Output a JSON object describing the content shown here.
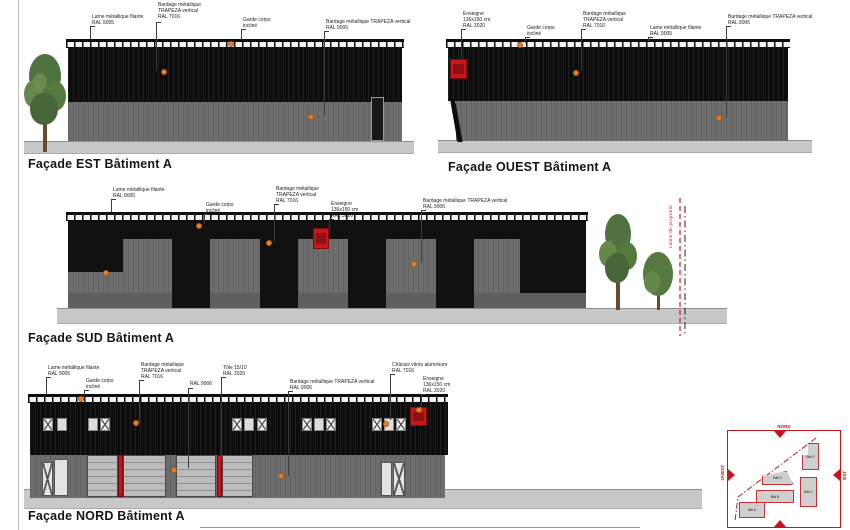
{
  "sheet": {
    "type_label": "Plan de façades",
    "colors": {
      "accent_red_ral3020": "#c3171b",
      "marker_orange": "#ee7e20",
      "cladding_dark_ral7016": "#0d0d0d",
      "cladding_gray_ral9006": "#6d6d6d",
      "ground_gray": "#c8c8c8"
    }
  },
  "facade_est": {
    "title": "Façade EST Bâtiment A",
    "annotations": [
      {
        "text": "Lame métallique filante\nRAL 9005"
      },
      {
        "text": "Bardage métallique\nTRAPEZA vertical\nRAL 7016"
      },
      {
        "text": "Garde corps\nincliné"
      },
      {
        "text": "Bardage métallique TRAPEZA vertical\nRAL 9006"
      }
    ]
  },
  "facade_ouest": {
    "title": "Façade OUEST Bâtiment A",
    "annotations": [
      {
        "text": "Enseigne\n136x150 cm\nRAL 3020"
      },
      {
        "text": "Garde corps\nincliné"
      },
      {
        "text": "Bardage métallique\nTRAPEZA vertical\nRAL 7016"
      },
      {
        "text": "Lame métallique filante\nRAL 9005"
      },
      {
        "text": "Bardage métallique TRAPEZA vertical\nRAL 9006"
      }
    ]
  },
  "facade_sud": {
    "title": "Façade SUD Bâtiment A",
    "boundary_label": "Limite de propriété",
    "annotations": [
      {
        "text": "Lame métallique filante\nRAL 9005"
      },
      {
        "text": "Garde corps\nincliné"
      },
      {
        "text": "Bardage métallique\nTRAPEZA vertical\nRAL 7016"
      },
      {
        "text": "Enseigne\n136x150 cm\nRAL 3020"
      },
      {
        "text": "Bardage métallique TRAPEZA vertical\nRAL 9006"
      }
    ]
  },
  "facade_nord": {
    "title": "Façade NORD Bâtiment A",
    "annotations": [
      {
        "text": "Lame métallique filante\nRAL 9005"
      },
      {
        "text": "Garde corps\nincliné"
      },
      {
        "text": "Bardage métallique\nTRAPEZA vertical\nRAL 7016"
      },
      {
        "text": "RAL 9006"
      },
      {
        "text": "Tôle 15/10\nRAL 3020"
      },
      {
        "text": "Bardage métallique TRAPEZA vertical\nRAL 9006"
      },
      {
        "text": "Châssis vitrés aluminium\nRAL 7016"
      },
      {
        "text": "Enseigne\n136x150 cm\nRAL 3020"
      }
    ]
  },
  "site_plan": {
    "directions": {
      "north": "NORD",
      "west": "OUEST",
      "east": "EST"
    },
    "buildings": [
      {
        "label": "Bât A"
      },
      {
        "label": "Bât B"
      },
      {
        "label": "Bât C"
      },
      {
        "label": "Bât D"
      },
      {
        "label": "Bât E"
      }
    ]
  }
}
